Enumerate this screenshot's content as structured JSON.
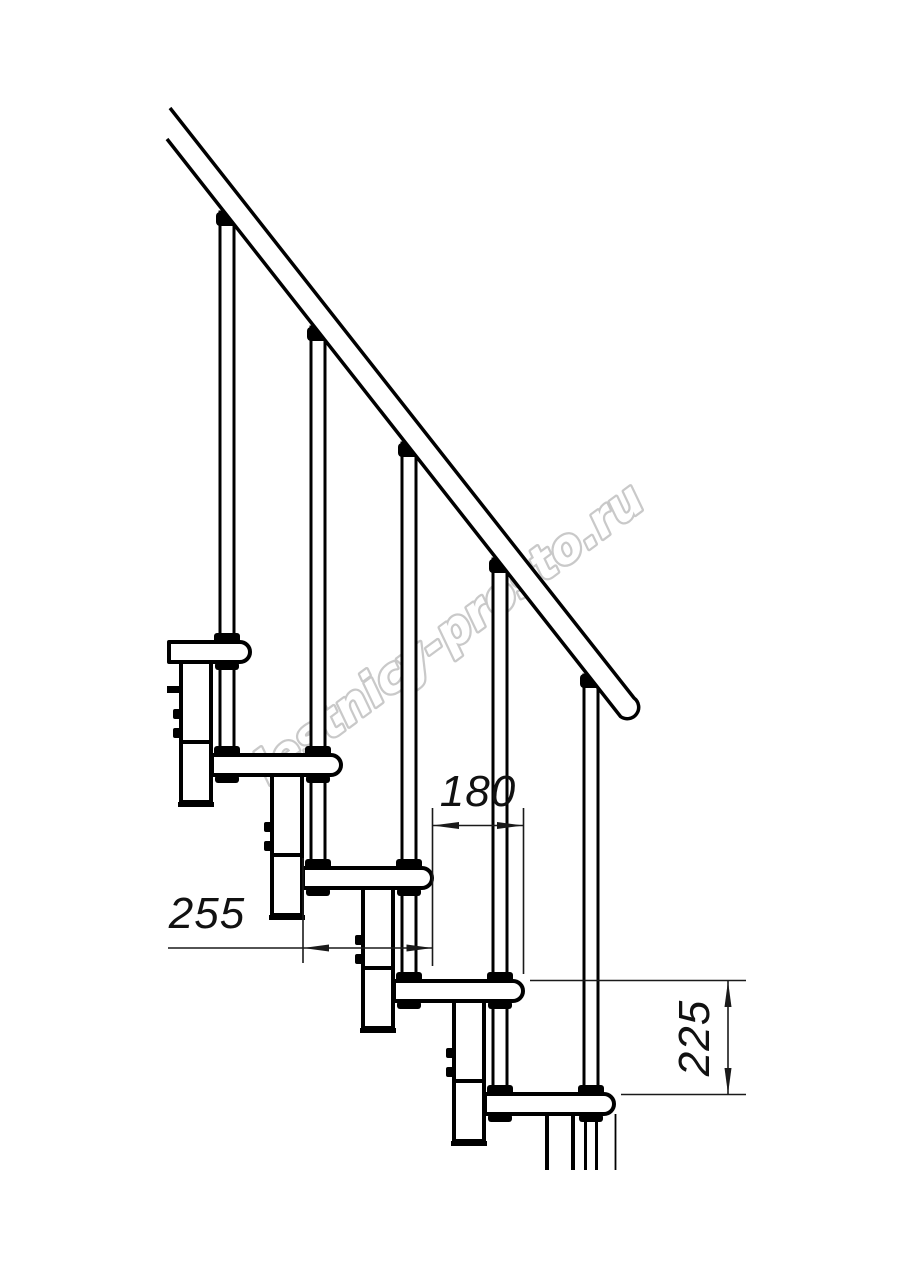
{
  "drawing": {
    "subject": "Modular staircase side elevation technical drawing",
    "background": "#ffffff",
    "line_color": "#000000",
    "watermark": {
      "text": "lestnicy-prosto.ru",
      "color": "#c6c6c6"
    },
    "dimensions": {
      "step_run": "180",
      "step_length": "255",
      "step_rise": "225"
    }
  }
}
